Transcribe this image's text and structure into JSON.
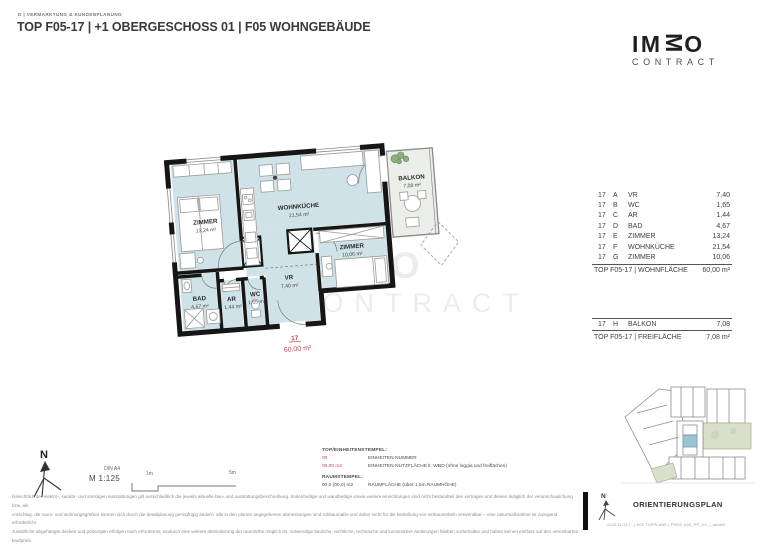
{
  "header": {
    "department": "D | VERMARKTUNG & KUNDENPLANUNG",
    "title": "TOP F05-17 | +1 OBERGESCHOSS 01 | F05 WOHNGEBÄUDE"
  },
  "logo": {
    "letters": [
      "I",
      "M",
      "M",
      "O"
    ],
    "subtitle": "CONTRACT"
  },
  "plan": {
    "rooms": [
      {
        "name": "ZIMMER",
        "area": "13,24 m²"
      },
      {
        "name": "WOHNKÜCHE",
        "area": "21,54 m²"
      },
      {
        "name": "ZIMMER",
        "area": "10,06 m²"
      },
      {
        "name": "VR",
        "area": "7,40 m²"
      },
      {
        "name": "BAD",
        "area": "4,67 m²"
      },
      {
        "name": "AR",
        "area": "1,44 m²"
      },
      {
        "name": "WC",
        "area": "1,65 m²"
      },
      {
        "name": "BALKON",
        "area": "7,08 m²"
      }
    ],
    "stamp": {
      "unit": "17",
      "area": "60,00 m²"
    },
    "watermark_line1": "IMMO",
    "watermark_line2": "CONTRACT",
    "colors": {
      "room_fill": "#cfe2e8",
      "wall": "#161616",
      "stamp_red": "#b5504c",
      "balcony_fill": "#eceeea"
    }
  },
  "area_tables": {
    "wohnflaeche": {
      "rows": [
        {
          "top": "17",
          "key": "A",
          "name": "VR",
          "value": "7,40"
        },
        {
          "top": "17",
          "key": "B",
          "name": "WC",
          "value": "1,65"
        },
        {
          "top": "17",
          "key": "C",
          "name": "AR",
          "value": "1,44"
        },
        {
          "top": "17",
          "key": "D",
          "name": "BAD",
          "value": "4,67"
        },
        {
          "top": "17",
          "key": "E",
          "name": "ZIMMER",
          "value": "13,24"
        },
        {
          "top": "17",
          "key": "F",
          "name": "WOHNKÜCHE",
          "value": "21,54"
        },
        {
          "top": "17",
          "key": "G",
          "name": "ZIMMER",
          "value": "10,06"
        }
      ],
      "total_label": "TOP F05-17 | WOHNFLÄCHE",
      "total_value": "60,00 m²"
    },
    "freiflaeche": {
      "rows": [
        {
          "top": "17",
          "key": "H",
          "name": "BALKON",
          "value": "7,08"
        }
      ],
      "total_label": "TOP F05-17 | FREIFLÄCHE",
      "total_value": "7,08 m²"
    }
  },
  "scale": {
    "north": "N",
    "din": "DIN A4",
    "ratio": "M 1:125",
    "bar_start": "1m",
    "bar_end": "5m"
  },
  "legend": {
    "stamp_title": "TOP/EINHEITENSTEMPEL:",
    "stamp_rows": [
      {
        "sample": "00",
        "desc": "EINHEITEN-NUMMER"
      },
      {
        "sample": "00,00 m2",
        "desc": "EINHEITEN-NUTZFLÄCHE lt. WBO (ohne loggia und freiflächen)"
      }
    ],
    "room_title": "RAUMSTEMPEL:",
    "room_rows": [
      {
        "sample": "00,0 (00,0) m2",
        "desc": "RAUMFLÄCHE (über 1,5m RAUMHÖHE)"
      }
    ]
  },
  "orientation": {
    "north": "N",
    "title": "ORIENTIERUNGSPLAN",
    "footnote": "2025.11.13 | - | D01 TOPPLÄNE | FW03_A00_PP_XX_-_aktuell"
  },
  "disclaimer": [
    "hinsichtlich der elektro-, sanitär- und sonstigen ausstattungen gilt ausschließlich die jeweils aktuelle bau- und ausstattungsbeschreibung. bodenbeläge und wandbeläge sowie weitere einrichtungen sind nicht bestandteil des vertrages und dienen lediglich der veranschaulichung bzw. als",
    "vorschlag. die raum- und wohnungsgrößen können sich durch die detailplanung geringfügig ändern. alle in den plänen angegebenen abmessungen sind rohbaumaße und daher nicht für die bestellung von einbaumöbeln verwendbar – eine naturmaßnahme ist zwingend erforderlich!",
    "zusätzliche abgehängte decken und pölzungen erfolgen nach erfordernis, wodurch eine weitere abminderung der raumhöhe möglich ist. notwendige bauliche, rechtliche, technische und konstruktive änderungen bleiben vorbehalten und haben keinen einfluss auf den vereinbarten kaufpreis.",
    "diese zeichnung bzw. ausarbeitung stellt das geistige eigentum der haring group bauträger gmbh dar und ist gesetzlich geschützt. jegliche vervielfältigung, veröffentlichung, überarbeitung, nutzung oder weitergabe an dritte im zusammenhang mit anderen projekten oder arbeiten bedarf",
    "der ausdrücklichen schriftlichen zustimmung des planers. unverbindliche plankopie - druckfehler, irrtümer und änderungen vorbehalten."
  ]
}
